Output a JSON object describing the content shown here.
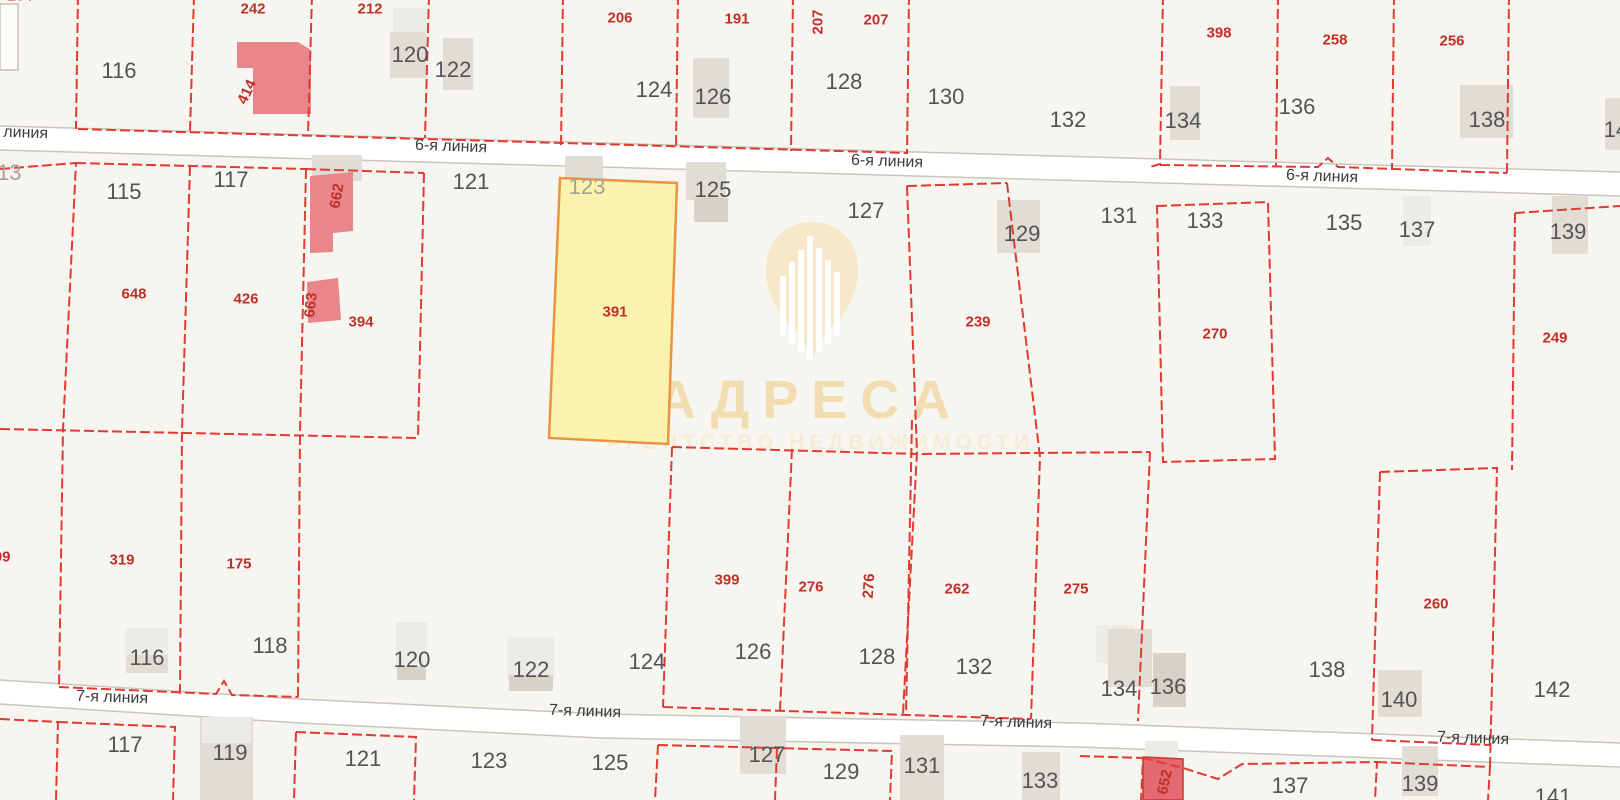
{
  "map": {
    "width": 1620,
    "height": 800,
    "colors": {
      "background": "#f7f5ef",
      "boundary": "#e03a32",
      "road_fill": "#ffffff",
      "road_edge": "#c9c5bd",
      "building_shades": [
        "#edebe5",
        "#e0ddd4",
        "#d6d2c8"
      ],
      "building_pink": "#e9868b",
      "building_red_fill": "#e26a70",
      "building_red_stroke": "#cb3531",
      "building_white_fill": "#fcfbf8",
      "building_white_stroke": "#c6c2ba",
      "highlight_fill": "#fbf2ae",
      "highlight_stroke": "#e89440",
      "label_black": "#535353",
      "label_red": "#c0302a",
      "label_gray": "#a5a198",
      "street_text": "#3c3c3c",
      "watermark_pin": "#f6e8c8",
      "watermark_title": "#f2ddb2",
      "watermark_subtitle": "#f5ecd8"
    },
    "watermark": {
      "title": "АДРЕСА",
      "subtitle": "АГЕНТСТВО НЕДВИЖИМОСТИ",
      "cx": 810,
      "title_y": 400,
      "subtitle_y": 443,
      "pin_path": "M812,222 C785,222 766,242 766,270 C766,296 780,316 795,330 C803,338 809,352 812,362 C815,352 821,338 829,330 C844,316 858,296 858,270 C858,242 839,222 812,222 Z",
      "bars": [
        [
          780,
          276,
          336
        ],
        [
          789,
          262,
          344
        ],
        [
          798,
          250,
          352
        ],
        [
          807,
          236,
          360
        ],
        [
          816,
          248,
          352
        ],
        [
          825,
          260,
          344
        ],
        [
          834,
          272,
          336
        ]
      ]
    },
    "roads": [
      {
        "name": "6-я линия",
        "top": [
          [
            0,
            126
          ],
          [
            1620,
            172
          ]
        ],
        "thickness": 24,
        "labels": [
          [
            12,
            133
          ],
          [
            451,
            147
          ],
          [
            887,
            162
          ],
          [
            1322,
            177
          ]
        ]
      },
      {
        "name": "7-я линия",
        "top": [
          [
            0,
            680
          ],
          [
            300,
            699
          ],
          [
            600,
            714
          ],
          [
            1080,
            723
          ],
          [
            1620,
            743
          ]
        ],
        "thickness": 24,
        "labels": [
          [
            112,
            698
          ],
          [
            585,
            712
          ],
          [
            1016,
            723
          ],
          [
            1473,
            739
          ]
        ]
      }
    ],
    "boundaries": [
      "M78,-5 L76,129",
      "M194,-5 L190,132",
      "M312,-5 L308,135",
      "M429,-5 L425,138",
      "M563,-5 L561,146",
      "M678,-5 L676,149",
      "M793,-5 L791,151",
      "M909,-5 L907,154",
      "M1163,-5 L1160,164 L1150,167",
      "M1278,-5 L1276,167",
      "M1394,-5 L1392,170",
      "M1509,-5 L1507,173",
      "M78,129 L425,139 L907,153",
      "M1160,165 L1318,167 L1328,158 L1338,167 L1507,173",
      "M0,169 L76,163 L63,430 L59,687",
      "M190,166 L182,431 L180,694",
      "M306,169 L300,433 L298,697",
      "M424,173 L418,438",
      "M0,429 L418,438",
      "M76,163 L306,169",
      "M306,169 L424,173",
      "M907,186 L1007,183",
      "M907,186 L917,452 L903,714",
      "M912,420 L906,716",
      "M1007,183 L1040,457 L1031,719",
      "M1157,206 L1268,202 L1275,459 L1163,462 Z",
      "M1515,213 L1620,206",
      "M1515,213 L1512,470",
      "M672,447 L917,454",
      "M922,454 L1150,452",
      "M672,447 L663,707",
      "M792,449 L780,711",
      "M1150,452 L1138,721",
      "M1380,472 L1497,468 L1490,767",
      "M1380,472 L1372,740",
      "M59,687 L216,694 L224,681 L232,695 L298,697",
      "M663,707 L1031,719",
      "M1372,740 L1490,745",
      "M0,719 L58,722 L56,800",
      "M58,722 L175,727 L173,800",
      "M296,732 L416,737 L414,800",
      "M296,732 L294,800",
      "M658,745 L892,751 L890,800",
      "M658,745 L655,800",
      "M777,749 L775,800",
      "M1080,756 L1143,758 L1141,800",
      "M1143,758 L1183,768 L1218,779 L1242,764 L1377,762 L1375,800",
      "M1377,762 L1490,767 L1488,800"
    ],
    "buildings": {
      "gray": [
        [
          393,
          8,
          35,
          40,
          0
        ],
        [
          390,
          32,
          36,
          46,
          1
        ],
        [
          443,
          38,
          30,
          52,
          1
        ],
        [
          693,
          58,
          36,
          60,
          1
        ],
        [
          565,
          156,
          38,
          26,
          1
        ],
        [
          686,
          162,
          40,
          38,
          1
        ],
        [
          694,
          198,
          34,
          24,
          2
        ],
        [
          997,
          200,
          43,
          53,
          1
        ],
        [
          1170,
          86,
          30,
          54,
          1
        ],
        [
          1460,
          85,
          53,
          53,
          1
        ],
        [
          1605,
          98,
          15,
          52,
          1
        ],
        [
          312,
          155,
          50,
          26,
          1
        ],
        [
          1403,
          196,
          28,
          50,
          0
        ],
        [
          1552,
          196,
          36,
          58,
          1
        ],
        [
          125,
          628,
          43,
          32,
          0
        ],
        [
          126,
          655,
          42,
          18,
          1
        ],
        [
          396,
          622,
          31,
          42,
          0
        ],
        [
          397,
          666,
          29,
          14,
          2
        ],
        [
          507,
          637,
          47,
          42,
          0
        ],
        [
          509,
          675,
          44,
          16,
          2
        ],
        [
          1096,
          625,
          39,
          38,
          0
        ],
        [
          1108,
          629,
          44,
          58,
          1
        ],
        [
          1153,
          653,
          33,
          54,
          2
        ],
        [
          1378,
          670,
          44,
          47,
          1
        ],
        [
          200,
          717,
          53,
          84,
          1
        ],
        [
          202,
          717,
          49,
          26,
          0
        ],
        [
          740,
          716,
          46,
          58,
          1
        ],
        [
          900,
          735,
          44,
          65,
          1
        ],
        [
          1022,
          752,
          38,
          48,
          1
        ],
        [
          1145,
          741,
          33,
          17,
          0
        ],
        [
          1402,
          746,
          36,
          50,
          1
        ]
      ],
      "pink": [
        "237,42 298,42 311,50 311,114 253,114 253,68 237,68",
        "310,176 353,172 353,231 333,233 333,252 310,253",
        "307,282 338,278 341,320 308,323"
      ],
      "red": [
        "1143,757 1183,759 1183,800 1143,800"
      ],
      "white": [
        [
          0,
          4,
          18,
          66
        ]
      ]
    },
    "highlight_parcel": {
      "number": "391",
      "points": "560,178 677,183 668,444 549,438"
    },
    "labels": {
      "black": [
        [
          "116",
          119,
          71
        ],
        [
          "120",
          410,
          55
        ],
        [
          "122",
          453,
          70
        ],
        [
          "124",
          654,
          90
        ],
        [
          "126",
          713,
          97
        ],
        [
          "128",
          844,
          82
        ],
        [
          "130",
          946,
          97
        ],
        [
          "132",
          1068,
          120
        ],
        [
          "134",
          1183,
          121
        ],
        [
          "136",
          1297,
          107
        ],
        [
          "138",
          1487,
          120
        ],
        [
          "140",
          1622,
          130
        ],
        [
          "115",
          124,
          192
        ],
        [
          "117",
          231,
          180
        ],
        [
          "121",
          471,
          182
        ],
        [
          "125",
          713,
          190
        ],
        [
          "127",
          866,
          211
        ],
        [
          "129",
          1022,
          234
        ],
        [
          "131",
          1119,
          216
        ],
        [
          "133",
          1205,
          221
        ],
        [
          "135",
          1344,
          223
        ],
        [
          "137",
          1417,
          230
        ],
        [
          "139",
          1568,
          232
        ],
        [
          "116",
          147,
          658
        ],
        [
          "118",
          270,
          646
        ],
        [
          "120",
          412,
          660
        ],
        [
          "122",
          531,
          670
        ],
        [
          "124",
          647,
          662
        ],
        [
          "126",
          753,
          652
        ],
        [
          "128",
          877,
          657
        ],
        [
          "132",
          974,
          667
        ],
        [
          "134",
          1119,
          689
        ],
        [
          "136",
          1168,
          687
        ],
        [
          "138",
          1327,
          670
        ],
        [
          "140",
          1399,
          700
        ],
        [
          "142",
          1552,
          690
        ],
        [
          "117",
          125,
          745
        ],
        [
          "119",
          230,
          753
        ],
        [
          "121",
          363,
          759
        ],
        [
          "123",
          489,
          761
        ],
        [
          "125",
          610,
          763
        ],
        [
          "127",
          767,
          755
        ],
        [
          "129",
          841,
          772
        ],
        [
          "131",
          922,
          766
        ],
        [
          "133",
          1040,
          781
        ],
        [
          "137",
          1290,
          786
        ],
        [
          "139",
          1420,
          784
        ],
        [
          "141",
          1553,
          797
        ]
      ],
      "gray": [
        [
          "113",
          4,
          173
        ],
        [
          "123",
          587,
          187
        ]
      ],
      "red": [
        [
          "204",
          20,
          -4,
          0
        ],
        [
          "242",
          253,
          9,
          0
        ],
        [
          "212",
          370,
          9,
          0
        ],
        [
          "206",
          620,
          18,
          0
        ],
        [
          "191",
          737,
          19,
          0
        ],
        [
          "207",
          818,
          22,
          -90
        ],
        [
          "207",
          876,
          20,
          0
        ],
        [
          "398",
          1219,
          33,
          0
        ],
        [
          "258",
          1335,
          40,
          0
        ],
        [
          "256",
          1452,
          41,
          0
        ],
        [
          "414",
          247,
          92,
          -65
        ],
        [
          "662",
          337,
          196,
          -80
        ],
        [
          "648",
          134,
          294,
          0
        ],
        [
          "426",
          246,
          299,
          0
        ],
        [
          "663",
          311,
          305,
          -84
        ],
        [
          "394",
          361,
          322,
          0
        ],
        [
          "391",
          615,
          312,
          0
        ],
        [
          "239",
          978,
          322,
          0
        ],
        [
          "270",
          1215,
          334,
          0
        ],
        [
          "249",
          1555,
          338,
          0
        ],
        [
          "309",
          -2,
          557,
          0
        ],
        [
          "319",
          122,
          560,
          0
        ],
        [
          "175",
          239,
          564,
          0
        ],
        [
          "399",
          727,
          580,
          0
        ],
        [
          "276",
          811,
          587,
          0
        ],
        [
          "276",
          869,
          586,
          -86
        ],
        [
          "262",
          957,
          589,
          0
        ],
        [
          "275",
          1076,
          589,
          0
        ],
        [
          "260",
          1436,
          604,
          0
        ],
        [
          "652",
          1165,
          782,
          -78
        ]
      ]
    }
  }
}
